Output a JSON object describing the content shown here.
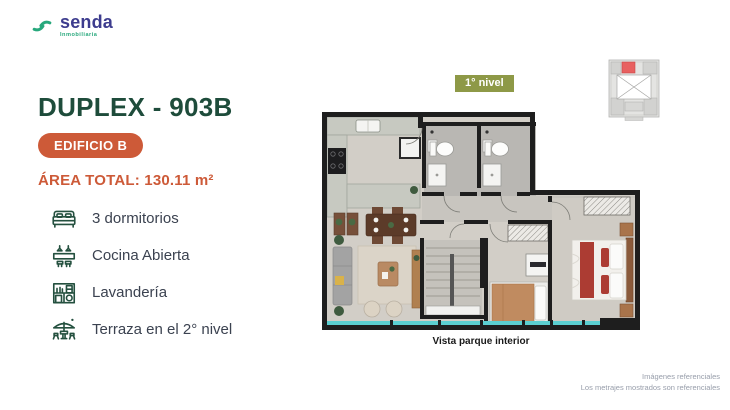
{
  "logo": {
    "name": "senda",
    "tagline": "Inmobiliaria"
  },
  "listing": {
    "title": "DUPLEX - 903B",
    "building_badge": "EDIFICIO B",
    "area_label": "ÁREA TOTAL: 130.11 m²",
    "features": [
      {
        "icon": "bed-icon",
        "label": "3 dormitorios"
      },
      {
        "icon": "kitchen-icon",
        "label": "Cocina Abierta"
      },
      {
        "icon": "laundry-icon",
        "label": "Lavandería"
      },
      {
        "icon": "terrace-icon",
        "label": "Terraza en el 2° nivel"
      }
    ]
  },
  "floorplan": {
    "level_badge": "1° nivel",
    "caption": "Vista parque interior"
  },
  "footer": {
    "line1": "Imágenes referenciales",
    "line2": "Los metrajes mostrados son referenciales"
  },
  "colors": {
    "brand_navy": "#3d3c8e",
    "brand_green": "#27a87c",
    "title_green": "#1e4c3b",
    "accent_orange": "#cd5a38",
    "olive_badge": "#8e9947",
    "window_teal": "#5bcfd1",
    "wall_black": "#1e1e1e",
    "keyplan_highlight": "#e86060"
  }
}
